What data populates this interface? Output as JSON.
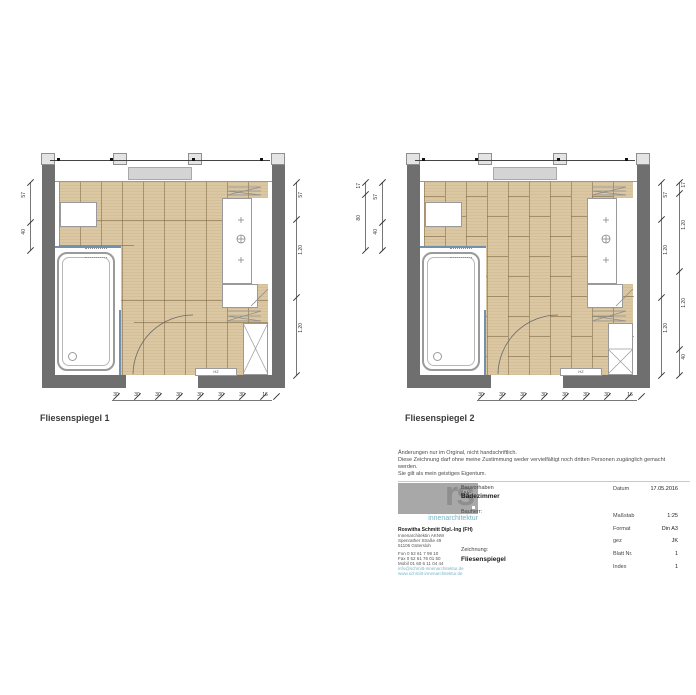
{
  "plans": [
    {
      "label": "Fliesenspiegel 1",
      "radiator_label": "HZ",
      "dims": {
        "left": [
          "57",
          "40"
        ],
        "right": [
          "57",
          "1.20",
          "1.20"
        ],
        "bottom": [
          "30",
          "30",
          "30",
          "30",
          "30",
          "30",
          "30",
          "16"
        ]
      }
    },
    {
      "label": "Fliesenspiegel 2",
      "radiator_label": "HZ",
      "dims": {
        "left_outer": [
          "17",
          "80"
        ],
        "left_inner": [
          "57",
          "40"
        ],
        "right_inner": [
          "57",
          "1.20",
          "1.20"
        ],
        "right_outer": [
          "17",
          "1.20",
          "1.20",
          "40"
        ],
        "bottom": [
          "30",
          "30",
          "30",
          "30",
          "30",
          "30",
          "30",
          "16"
        ]
      }
    }
  ],
  "title_block": {
    "notes": [
      "Änderungen nur im Orginal, nicht handschriftlich.",
      "Diese Zeichnung darf ohne meine Zustimmung weder vervielfältigt noch dritten Personen zugänglich gemacht",
      "werden.",
      "Sie gilt als mein geistiges Eigentum."
    ],
    "logo": {
      "text": "rs",
      "subtitle": "innenarchitektur"
    },
    "contact": {
      "name": "Roswitha Schmitt Dipl.-Ing (FH)",
      "address": [
        "Innenarchitektin AKNW",
        "Spenrather Straße 49",
        "51105 Gütersloh"
      ],
      "phones": [
        "Fon    0 52 61 7 99 10",
        "Fax    0 52 61 76 01 50",
        "Mobil  01 60 6 11 04 44"
      ],
      "web": [
        "info@schmitt-innenarchitektur.de",
        "www.schmitt-innenarchitektur.de"
      ]
    },
    "fields": {
      "bauvorhaben_label": "Bauvorhaben / Nr:",
      "bauvorhaben_value": "Badezimmer",
      "bauherr_label": "Bauherr:",
      "zeichnung_label": "Zeichnung:",
      "zeichnung_value": "Fliesenspiegel"
    },
    "meta": [
      {
        "label": "Datum",
        "value": "17.05.2016"
      },
      {
        "label": "Maßstab",
        "value": "1:25"
      },
      {
        "label": "Format",
        "value": "Din A3"
      },
      {
        "label": "gez",
        "value": "JK"
      },
      {
        "label": "Blatt Nr.",
        "value": "1"
      },
      {
        "label": "Index",
        "value": "1"
      }
    ]
  },
  "colors": {
    "wall": "#6f6f6f",
    "tile": "#dbc7a2",
    "tile_joint": "#826846",
    "glass_blue": "#7191ad",
    "accent_teal": "#7ab5c8"
  }
}
